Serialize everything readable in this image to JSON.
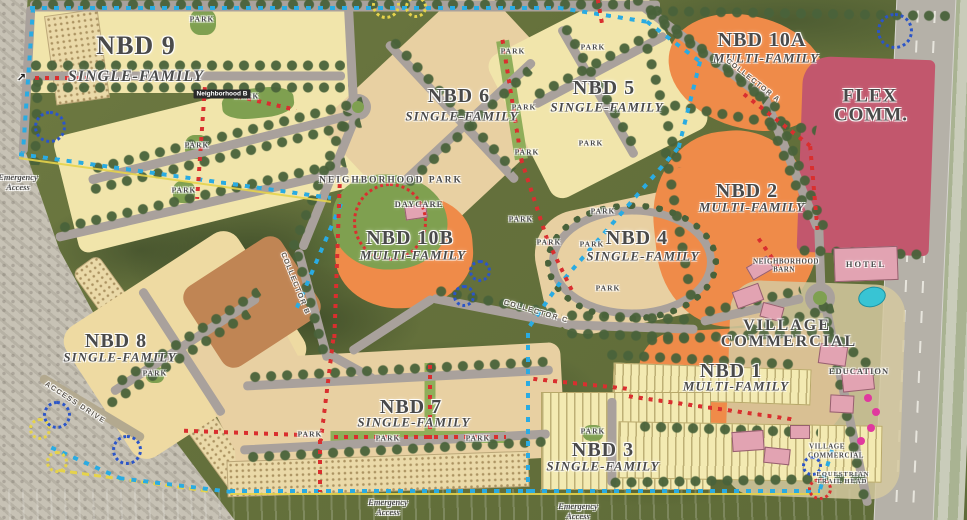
{
  "map": {
    "neighborhoods": {
      "nbd9": {
        "title": "NBD 9",
        "subtitle": "SINGLE-FAMILY"
      },
      "nbd8": {
        "title": "NBD 8",
        "subtitle": "SINGLE-FAMILY"
      },
      "nbd7": {
        "title": "NBD 7",
        "subtitle": "SINGLE-FAMILY"
      },
      "nbd6": {
        "title": "NBD 6",
        "subtitle": "SINGLE-FAMILY"
      },
      "nbd5": {
        "title": "NBD 5",
        "subtitle": "SINGLE-FAMILY"
      },
      "nbd4": {
        "title": "NBD 4",
        "subtitle": "SINGLE-FAMILY"
      },
      "nbd3": {
        "title": "NBD 3",
        "subtitle": "SINGLE-FAMILY"
      },
      "nbd2": {
        "title": "NBD 2",
        "subtitle": "MULTI-FAMILY"
      },
      "nbd1": {
        "title": "NBD 1",
        "subtitle": "MULTI-FAMILY"
      },
      "nbd10a": {
        "title": "NBD 10A",
        "subtitle": "MULTI-FAMILY"
      },
      "nbd10b": {
        "title": "NBD 10B",
        "subtitle": "MULTI-FAMILY"
      }
    },
    "districts": {
      "flex_commercial": {
        "line1": "FLEX",
        "line2": "COMM."
      },
      "village_commercial": {
        "line1": "VILLAGE",
        "line2": "COMMERCIAL"
      }
    },
    "pois": {
      "park": "PARK",
      "hotel": "HOTEL",
      "education": "EDUCATION",
      "daycare": "DAYCARE",
      "neighborhood_park": "NEIGHBORHOOD PARK",
      "neighborhood_barn": {
        "line1": "NEIGHBORHOOD",
        "line2": "BARN"
      },
      "neighborhood_b": "Neighborhood B",
      "village_commercial_small": {
        "line1": "VILLAGE",
        "line2": "COMMERCIAL"
      },
      "equestrian_trail_head": {
        "line1": "EQUESTRIAN",
        "line2": "TRAIL HEAD"
      }
    },
    "roads": {
      "collector_a": "COLLECTOR A",
      "collector_b": "COLLECTOR B",
      "collector_c": "COLLECTOR C",
      "access_drive": "ACCESS DRIVE"
    },
    "notes": {
      "emergency_access": "Emergency Access",
      "arrow_ne": "↗"
    }
  },
  "colors": {
    "sf_yellow": "#f1e5ab",
    "sf_tan": "#e8d0a2",
    "mf_orange": "#ef8b49",
    "flex_red": "#c2576d",
    "building_pink": "#e2a3b2",
    "road": "#a9a19c",
    "trail_blue": "#2aabe2",
    "trail_red": "#d92f2f",
    "trail_yellow": "#e6d34b",
    "base_green": "#68743f",
    "dark_green": "#55653a",
    "tree": "#49623a",
    "park_green": "#7fa050",
    "desert": "#c6c1b4",
    "dirt": "#c08554"
  }
}
